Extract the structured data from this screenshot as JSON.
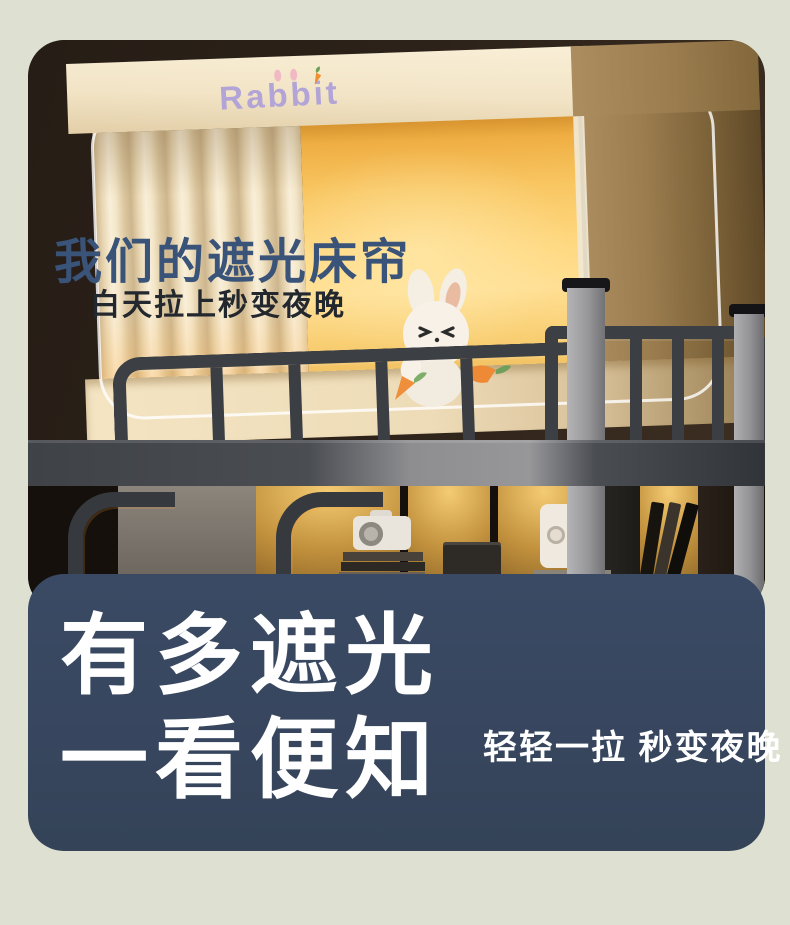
{
  "page": {
    "background_color": "#dee0d2"
  },
  "photo": {
    "brand_logo": "Rabbit",
    "headline": "我们的遮光床帘",
    "subheadline": "白天拉上秒变夜晚",
    "headline_color": "#3a5379",
    "blind_glow_color": "#ffd982",
    "curtain_color": "#f2e4c6"
  },
  "banner": {
    "background_color": "#37465e",
    "title_line1": "有多遮光",
    "title_line2": "一看便知",
    "caption": "轻轻一拉 秒变夜晚",
    "text_color": "#ffffff"
  }
}
